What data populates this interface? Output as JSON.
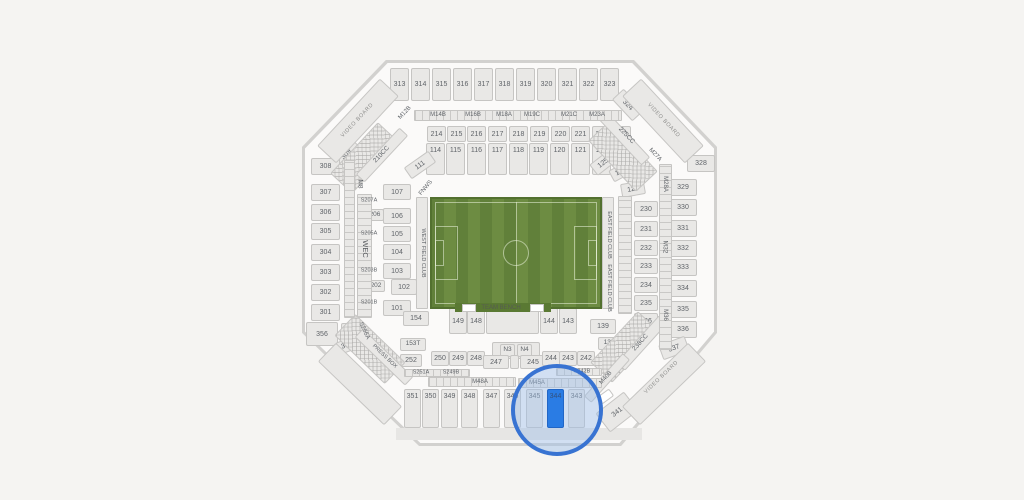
{
  "app": {
    "description_label": "Stadium seating map with soccer field and highlighted section"
  },
  "colors": {
    "background": "#f5f4f2",
    "stadium_border": "#d2d1cf",
    "stadium_fill": "#fbfaf9",
    "section_fill": "#e9e8e6",
    "section_border": "#c6c5c3",
    "label": "#5f6368",
    "field_stripe_dark": "#61803a",
    "field_stripe_light": "#6d8c42",
    "field_frame": "#52702f",
    "highlight_fill": "#2a7ce4",
    "highlight_ring": "#3873d2",
    "highlight_tint": "rgba(158,190,232,0.45)",
    "highlight_label": "#33517e"
  },
  "field": {
    "x": 430,
    "y": 197,
    "w": 172,
    "h": 112,
    "bench": {
      "x": 455,
      "y": 303,
      "w": 96,
      "h": 9,
      "fill": "#5a7933"
    },
    "labels": {
      "bench": "TEAM BENCH",
      "west_club": "WEST FIELD CLUB",
      "east_club": "EAST FIELD CLUB",
      "corner_suite": "FNWS"
    }
  },
  "highlight": {
    "section": "344",
    "cx": 557,
    "cy": 410,
    "r": 46
  },
  "sections": [
    {
      "label": "313",
      "x": 390,
      "y": 68,
      "w": 19,
      "h": 33
    },
    {
      "label": "314",
      "x": 411,
      "y": 68,
      "w": 19,
      "h": 33
    },
    {
      "label": "315",
      "x": 432,
      "y": 68,
      "w": 19,
      "h": 33
    },
    {
      "label": "316",
      "x": 453,
      "y": 68,
      "w": 19,
      "h": 33
    },
    {
      "label": "317",
      "x": 474,
      "y": 68,
      "w": 19,
      "h": 33
    },
    {
      "label": "318",
      "x": 495,
      "y": 68,
      "w": 19,
      "h": 33
    },
    {
      "label": "319",
      "x": 516,
      "y": 68,
      "w": 19,
      "h": 33
    },
    {
      "label": "320",
      "x": 537,
      "y": 68,
      "w": 19,
      "h": 33
    },
    {
      "label": "321",
      "x": 558,
      "y": 68,
      "w": 19,
      "h": 33
    },
    {
      "label": "322",
      "x": 579,
      "y": 68,
      "w": 19,
      "h": 33
    },
    {
      "label": "323",
      "x": 600,
      "y": 68,
      "w": 19,
      "h": 33
    },
    {
      "label": "324",
      "x": 613,
      "y": 97,
      "w": 30,
      "h": 16,
      "r": 47
    },
    {
      "label": "309",
      "x": 331,
      "y": 146,
      "w": 30,
      "h": 16,
      "r": -47
    },
    {
      "label": "214",
      "x": 427,
      "y": 126,
      "w": 19,
      "h": 16
    },
    {
      "label": "215",
      "x": 447,
      "y": 126,
      "w": 19,
      "h": 16
    },
    {
      "label": "216",
      "x": 467,
      "y": 126,
      "w": 19,
      "h": 16
    },
    {
      "label": "217",
      "x": 488,
      "y": 126,
      "w": 19,
      "h": 16
    },
    {
      "label": "218",
      "x": 509,
      "y": 126,
      "w": 19,
      "h": 16
    },
    {
      "label": "219",
      "x": 530,
      "y": 126,
      "w": 19,
      "h": 16
    },
    {
      "label": "220",
      "x": 551,
      "y": 126,
      "w": 19,
      "h": 16
    },
    {
      "label": "221",
      "x": 571,
      "y": 126,
      "w": 19,
      "h": 16
    },
    {
      "label": "222",
      "x": 592,
      "y": 126,
      "w": 19,
      "h": 16
    },
    {
      "label": "223",
      "x": 612,
      "y": 126,
      "w": 19,
      "h": 16
    },
    {
      "label": "114",
      "x": 426,
      "y": 143,
      "w": 19,
      "h": 32,
      "top": true
    },
    {
      "label": "115",
      "x": 446,
      "y": 143,
      "w": 19,
      "h": 32,
      "top": true
    },
    {
      "label": "116",
      "x": 467,
      "y": 143,
      "w": 19,
      "h": 32,
      "top": true
    },
    {
      "label": "117",
      "x": 488,
      "y": 143,
      "w": 19,
      "h": 32,
      "top": true
    },
    {
      "label": "118",
      "x": 509,
      "y": 143,
      "w": 19,
      "h": 32,
      "top": true
    },
    {
      "label": "119",
      "x": 529,
      "y": 143,
      "w": 19,
      "h": 32,
      "top": true
    },
    {
      "label": "120",
      "x": 550,
      "y": 143,
      "w": 19,
      "h": 32,
      "top": true
    },
    {
      "label": "121",
      "x": 571,
      "y": 143,
      "w": 19,
      "h": 32,
      "top": true
    },
    {
      "label": "122",
      "x": 592,
      "y": 143,
      "w": 19,
      "h": 32,
      "top": true
    },
    {
      "label": "308",
      "x": 311,
      "y": 158,
      "w": 29,
      "h": 17
    },
    {
      "label": "307",
      "x": 311,
      "y": 184,
      "w": 29,
      "h": 17
    },
    {
      "label": "306",
      "x": 311,
      "y": 204,
      "w": 29,
      "h": 17
    },
    {
      "label": "305",
      "x": 311,
      "y": 223,
      "w": 29,
      "h": 17
    },
    {
      "label": "304",
      "x": 311,
      "y": 244,
      "w": 29,
      "h": 17
    },
    {
      "label": "303",
      "x": 311,
      "y": 264,
      "w": 29,
      "h": 17
    },
    {
      "label": "302",
      "x": 311,
      "y": 284,
      "w": 29,
      "h": 17
    },
    {
      "label": "301",
      "x": 311,
      "y": 304,
      "w": 29,
      "h": 17
    },
    {
      "label": "356",
      "x": 306,
      "y": 322,
      "w": 32,
      "h": 24
    },
    {
      "label": "356",
      "x": 341,
      "y": 323,
      "w": 16,
      "h": 14,
      "f": 6
    },
    {
      "label": "355",
      "x": 337,
      "y": 339,
      "w": 20,
      "h": 13,
      "r": -20
    },
    {
      "label": "328",
      "x": 687,
      "y": 155,
      "w": 28,
      "h": 17
    },
    {
      "label": "329",
      "x": 669,
      "y": 179,
      "w": 28,
      "h": 17
    },
    {
      "label": "330",
      "x": 669,
      "y": 199,
      "w": 28,
      "h": 17
    },
    {
      "label": "331",
      "x": 669,
      "y": 220,
      "w": 28,
      "h": 17
    },
    {
      "label": "332",
      "x": 669,
      "y": 240,
      "w": 28,
      "h": 17
    },
    {
      "label": "333",
      "x": 669,
      "y": 259,
      "w": 28,
      "h": 17
    },
    {
      "label": "334",
      "x": 669,
      "y": 280,
      "w": 28,
      "h": 17
    },
    {
      "label": "335",
      "x": 669,
      "y": 301,
      "w": 28,
      "h": 17
    },
    {
      "label": "336",
      "x": 669,
      "y": 321,
      "w": 28,
      "h": 17
    },
    {
      "label": "337",
      "x": 660,
      "y": 340,
      "w": 28,
      "h": 16,
      "r": -20
    },
    {
      "label": "341",
      "x": 599,
      "y": 400,
      "w": 36,
      "h": 24,
      "r": -38
    },
    {
      "label": "230",
      "x": 634,
      "y": 201,
      "w": 24,
      "h": 16
    },
    {
      "label": "231",
      "x": 634,
      "y": 221,
      "w": 24,
      "h": 16
    },
    {
      "label": "232",
      "x": 634,
      "y": 240,
      "w": 24,
      "h": 16
    },
    {
      "label": "233",
      "x": 634,
      "y": 258,
      "w": 24,
      "h": 16
    },
    {
      "label": "234",
      "x": 634,
      "y": 277,
      "w": 24,
      "h": 16
    },
    {
      "label": "235",
      "x": 634,
      "y": 295,
      "w": 24,
      "h": 16
    },
    {
      "label": "236",
      "x": 634,
      "y": 313,
      "w": 24,
      "h": 16
    },
    {
      "label": "111",
      "x": 405,
      "y": 158,
      "w": 30,
      "h": 14,
      "r": -35
    },
    {
      "label": "107",
      "x": 383,
      "y": 184,
      "w": 28,
      "h": 16
    },
    {
      "label": "106",
      "x": 383,
      "y": 208,
      "w": 28,
      "h": 16
    },
    {
      "label": "105",
      "x": 383,
      "y": 226,
      "w": 28,
      "h": 16
    },
    {
      "label": "104",
      "x": 383,
      "y": 244,
      "w": 28,
      "h": 16
    },
    {
      "label": "103",
      "x": 383,
      "y": 263,
      "w": 28,
      "h": 16
    },
    {
      "label": "102",
      "x": 391,
      "y": 279,
      "w": 26,
      "h": 16
    },
    {
      "label": "101",
      "x": 383,
      "y": 300,
      "w": 28,
      "h": 16
    },
    {
      "label": "206",
      "x": 366,
      "y": 209,
      "w": 18,
      "h": 12,
      "f": 6.5
    },
    {
      "label": "202",
      "x": 367,
      "y": 280,
      "w": 18,
      "h": 12,
      "f": 6.5
    },
    {
      "label": "125",
      "x": 591,
      "y": 156,
      "w": 24,
      "h": 14,
      "r": -38
    },
    {
      "label": "126",
      "x": 610,
      "y": 165,
      "w": 22,
      "h": 13,
      "r": -28
    },
    {
      "label": "129",
      "x": 621,
      "y": 182,
      "w": 24,
      "h": 14,
      "r": -10
    },
    {
      "label": "154",
      "x": 403,
      "y": 311,
      "w": 26,
      "h": 15
    },
    {
      "label": "139",
      "x": 590,
      "y": 319,
      "w": 26,
      "h": 15
    },
    {
      "label": "149",
      "x": 449,
      "y": 308,
      "w": 18,
      "h": 26
    },
    {
      "label": "148",
      "x": 467,
      "y": 308,
      "w": 18,
      "h": 26
    },
    {
      "x": 486,
      "y": 308,
      "w": 53,
      "h": 26
    },
    {
      "label": "144",
      "x": 540,
      "y": 308,
      "w": 18,
      "h": 26
    },
    {
      "label": "143",
      "x": 559,
      "y": 308,
      "w": 18,
      "h": 26
    },
    {
      "label": "153T",
      "x": 400,
      "y": 338,
      "w": 26,
      "h": 13,
      "f": 6.5
    },
    {
      "label": "139T",
      "x": 598,
      "y": 337,
      "w": 26,
      "h": 13,
      "f": 6.5
    },
    {
      "x": 492,
      "y": 342,
      "w": 48,
      "h": 17
    },
    {
      "label": "N3",
      "x": 500,
      "y": 344,
      "w": 15,
      "h": 13,
      "f": 6.5
    },
    {
      "label": "N4",
      "x": 517,
      "y": 344,
      "w": 15,
      "h": 13,
      "f": 6.5
    },
    {
      "label": "250",
      "x": 431,
      "y": 351,
      "w": 18,
      "h": 15
    },
    {
      "label": "249",
      "x": 449,
      "y": 351,
      "w": 18,
      "h": 15
    },
    {
      "label": "248",
      "x": 467,
      "y": 351,
      "w": 18,
      "h": 15
    },
    {
      "label": "247",
      "x": 483,
      "y": 355,
      "w": 26,
      "h": 14
    },
    {
      "x": 510,
      "y": 355,
      "w": 9,
      "h": 14
    },
    {
      "label": "245",
      "x": 520,
      "y": 355,
      "w": 26,
      "h": 14
    },
    {
      "label": "244",
      "x": 542,
      "y": 351,
      "w": 18,
      "h": 15
    },
    {
      "label": "243",
      "x": 559,
      "y": 351,
      "w": 18,
      "h": 15
    },
    {
      "label": "242",
      "x": 577,
      "y": 351,
      "w": 18,
      "h": 15
    },
    {
      "label": "252",
      "x": 400,
      "y": 354,
      "w": 22,
      "h": 13
    },
    {
      "label": "351",
      "x": 404,
      "y": 389,
      "w": 17,
      "h": 39,
      "top": true
    },
    {
      "label": "350",
      "x": 422,
      "y": 389,
      "w": 17,
      "h": 39,
      "top": true
    },
    {
      "label": "349",
      "x": 441,
      "y": 389,
      "w": 17,
      "h": 39,
      "top": true
    },
    {
      "label": "348",
      "x": 461,
      "y": 389,
      "w": 17,
      "h": 39,
      "top": true
    },
    {
      "label": "347",
      "x": 483,
      "y": 389,
      "w": 17,
      "h": 39,
      "top": true
    },
    {
      "label": "346",
      "x": 504,
      "y": 389,
      "w": 17,
      "h": 39,
      "top": true
    },
    {
      "label": "345",
      "x": 526,
      "y": 389,
      "w": 17,
      "h": 39,
      "top": true
    },
    {
      "label": "344",
      "x": 547,
      "y": 389,
      "w": 17,
      "h": 39,
      "top": true,
      "fill": "#2a7ce4",
      "border": "#2166c6",
      "c": "#33517e",
      "z": 7
    },
    {
      "label": "343",
      "x": 568,
      "y": 389,
      "w": 17,
      "h": 39,
      "top": true
    },
    {
      "x": 598,
      "y": 392,
      "w": 15,
      "h": 9,
      "r": -36,
      "fill": "#ffffff"
    },
    {
      "x": 312,
      "y": 108,
      "w": 92,
      "h": 26,
      "r": -47,
      "click": false,
      "name": "video-board-stand-top-left"
    },
    {
      "x": 617,
      "y": 108,
      "w": 92,
      "h": 26,
      "r": 47,
      "click": false,
      "name": "video-board-stand-top-right"
    },
    {
      "x": 618,
      "y": 371,
      "w": 92,
      "h": 26,
      "r": -44,
      "click": false,
      "name": "video-board-stand-bottom-right"
    },
    {
      "x": 314,
      "y": 371,
      "w": 92,
      "h": 26,
      "r": 44,
      "click": false,
      "name": "stand-bottom-left"
    },
    {
      "x": 330,
      "y": 143,
      "w": 70,
      "h": 30,
      "r": -47,
      "hatch": true,
      "click": false,
      "name": "suite-block-top-left"
    },
    {
      "x": 588,
      "y": 141,
      "w": 70,
      "h": 30,
      "r": 47,
      "hatch": true,
      "click": false,
      "name": "suite-block-top-right"
    },
    {
      "x": 590,
      "y": 332,
      "w": 70,
      "h": 30,
      "r": -47,
      "hatch": true,
      "click": false,
      "name": "suite-block-bottom-right"
    },
    {
      "x": 335,
      "y": 334,
      "w": 70,
      "h": 30,
      "r": 44,
      "hatch": true,
      "click": false,
      "name": "suite-block-bottom-left"
    },
    {
      "x": 349,
      "y": 351,
      "w": 70,
      "h": 12,
      "r": 44,
      "name": "section-press-box"
    },
    {
      "x": 350,
      "y": 149,
      "w": 64,
      "h": 12,
      "r": -47,
      "name": "section-210cc"
    },
    {
      "x": 592,
      "y": 132,
      "w": 64,
      "h": 12,
      "r": 47,
      "name": "section-225cc"
    },
    {
      "x": 610,
      "y": 337,
      "w": 64,
      "h": 12,
      "r": -48,
      "name": "section-238cc"
    },
    {
      "x": 578,
      "y": 373,
      "w": 58,
      "h": 10,
      "r": -48,
      "name": "section-m40b"
    }
  ],
  "strips": [
    {
      "x": 414,
      "y": 110,
      "w": 208,
      "h": 11,
      "dir": "h",
      "name": "mezzanine-north-strip"
    },
    {
      "x": 357,
      "y": 194,
      "w": 15,
      "h": 124,
      "dir": "v",
      "name": "suite-west-strip"
    },
    {
      "x": 344,
      "y": 160,
      "w": 11,
      "h": 158,
      "dir": "v",
      "name": "west-upper-strip"
    },
    {
      "x": 618,
      "y": 196,
      "w": 14,
      "h": 118,
      "dir": "v",
      "name": "east-inner-strip"
    },
    {
      "x": 659,
      "y": 164,
      "w": 13,
      "h": 186,
      "dir": "v",
      "name": "mezzanine-east-strip"
    },
    {
      "x": 416,
      "y": 197,
      "w": 12,
      "h": 112,
      "name": "west-field-club-strip"
    },
    {
      "x": 602,
      "y": 197,
      "w": 12,
      "h": 112,
      "name": "east-field-club-strip"
    },
    {
      "x": 404,
      "y": 369,
      "w": 66,
      "h": 8,
      "dir": "h",
      "name": "suite-south-west-strip"
    },
    {
      "x": 556,
      "y": 368,
      "w": 46,
      "h": 8,
      "dir": "h",
      "name": "suite-south-east-strip"
    },
    {
      "x": 428,
      "y": 377,
      "w": 88,
      "h": 10,
      "dir": "h",
      "name": "section-m48a-strip"
    },
    {
      "x": 518,
      "y": 378,
      "w": 84,
      "h": 10,
      "dir": "h",
      "name": "section-m45a-strip"
    }
  ],
  "labels": [
    {
      "t": "VIDEO BOARD",
      "x": 358,
      "y": 121,
      "r": -47,
      "f": 5.5,
      "c": "#8f8f8d",
      "ls": 0.6
    },
    {
      "t": "VIDEO BOARD",
      "x": 663,
      "y": 121,
      "r": 47,
      "f": 5.5,
      "c": "#8f8f8d",
      "ls": 0.6
    },
    {
      "t": "VIDEO BOARD",
      "x": 662,
      "y": 378,
      "r": -44,
      "f": 5.5,
      "c": "#8f8f8d",
      "ls": 0.6
    },
    {
      "t": "PRESS BOX",
      "x": 384,
      "y": 357,
      "r": 44,
      "f": 5.5
    },
    {
      "t": "210CC",
      "x": 382,
      "y": 155,
      "r": -47,
      "f": 6.5
    },
    {
      "t": "M12B",
      "x": 405,
      "y": 113,
      "r": -47,
      "f": 6
    },
    {
      "t": "225CC",
      "x": 626,
      "y": 136,
      "r": 47,
      "f": 6.5
    },
    {
      "t": "M27A",
      "x": 655,
      "y": 155,
      "r": 47,
      "f": 6
    },
    {
      "t": "238CC",
      "x": 641,
      "y": 343,
      "r": -48,
      "f": 6.5
    },
    {
      "t": "M40B",
      "x": 606,
      "y": 378,
      "r": -48,
      "f": 6
    },
    {
      "t": "FNWS",
      "x": 426,
      "y": 188,
      "r": -50,
      "f": 6
    },
    {
      "t": "M8",
      "x": 359,
      "y": 184,
      "r": 90,
      "f": 6.5
    },
    {
      "t": "WEC",
      "x": 365,
      "y": 249,
      "r": 90,
      "f": 7.5,
      "c": "#55585c"
    },
    {
      "t": "S256A",
      "x": 364,
      "y": 331,
      "r": 65,
      "f": 6
    },
    {
      "t": "S207A",
      "x": 369,
      "y": 201,
      "f": 5.5
    },
    {
      "t": "S205A",
      "x": 369,
      "y": 234,
      "f": 5.5
    },
    {
      "t": "S203B",
      "x": 369,
      "y": 271,
      "f": 5.5
    },
    {
      "t": "S201B",
      "x": 369,
      "y": 303,
      "f": 5.5
    },
    {
      "t": "M28A",
      "x": 665,
      "y": 184,
      "r": 90,
      "f": 6
    },
    {
      "t": "M32",
      "x": 664,
      "y": 247,
      "r": 90,
      "f": 6.5
    },
    {
      "t": "M36",
      "x": 665,
      "y": 315,
      "r": 90,
      "f": 6
    },
    {
      "t": "WEST FIELD CLUB",
      "x": 422,
      "y": 253,
      "r": 90,
      "f": 5.5
    },
    {
      "t": "EAST FIELD CLUB",
      "x": 608,
      "y": 235,
      "r": 90,
      "f": 5.5
    },
    {
      "t": "EAST FIELD CLUB",
      "x": 608,
      "y": 288,
      "r": 90,
      "f": 5.5
    },
    {
      "t": "TEAM BENCH",
      "x": 501,
      "y": 308,
      "f": 6,
      "c": "#565b52"
    },
    {
      "t": "M14B",
      "x": 438,
      "y": 115,
      "f": 6
    },
    {
      "t": "M16B",
      "x": 473,
      "y": 115,
      "f": 6
    },
    {
      "t": "M18A",
      "x": 504,
      "y": 115,
      "f": 6
    },
    {
      "t": "M19C",
      "x": 532,
      "y": 115,
      "f": 6
    },
    {
      "t": "M21C",
      "x": 569,
      "y": 115,
      "f": 6
    },
    {
      "t": "M23A",
      "x": 597,
      "y": 115,
      "f": 6
    },
    {
      "t": "M48A",
      "x": 480,
      "y": 382,
      "f": 6
    },
    {
      "t": "M45A",
      "x": 537,
      "y": 383,
      "f": 6
    },
    {
      "t": "S251A",
      "x": 421,
      "y": 373,
      "f": 5.5
    },
    {
      "t": "S249B",
      "x": 451,
      "y": 373,
      "f": 5.5
    },
    {
      "t": "S242B",
      "x": 582,
      "y": 372,
      "f": 5.5
    }
  ]
}
